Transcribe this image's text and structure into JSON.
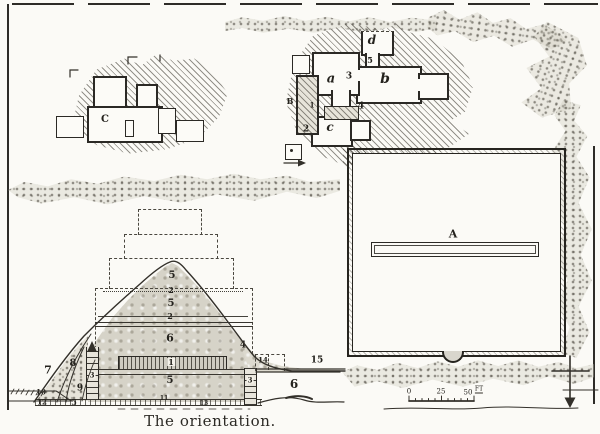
{
  "figure": {
    "caption": "The orientation."
  },
  "icons": {
    "north_arrow": "crossed-down-arrow"
  },
  "plan": {
    "building_c": "C",
    "court_b": "B",
    "room_a": "a",
    "room_b": "b",
    "room_c": "c",
    "room_d": "d",
    "num_1": "1",
    "num_2": "2",
    "num_3": "3",
    "num_4": "4",
    "num_5": "5",
    "enclosure_a": "A"
  },
  "section": {
    "layers": {
      "l5_top": "5",
      "l2_upper": "2",
      "l5_mid": "5",
      "l2_lower": "2",
      "l6": "6",
      "l1": "1",
      "l5_base": "5"
    },
    "left": {
      "n7": "7",
      "n8": "8",
      "n9": "9",
      "n10": "10",
      "n12": "12",
      "n5": "5",
      "col3": "3"
    },
    "right": {
      "n4": "4",
      "n14": "14",
      "n15": "15",
      "col3": "3",
      "n6": "6"
    },
    "base": {
      "n11": "11",
      "n13": "13"
    }
  },
  "scale_bar": {
    "zero": "0",
    "twentyfive": "25",
    "fifty": "50",
    "unit": "FT"
  }
}
